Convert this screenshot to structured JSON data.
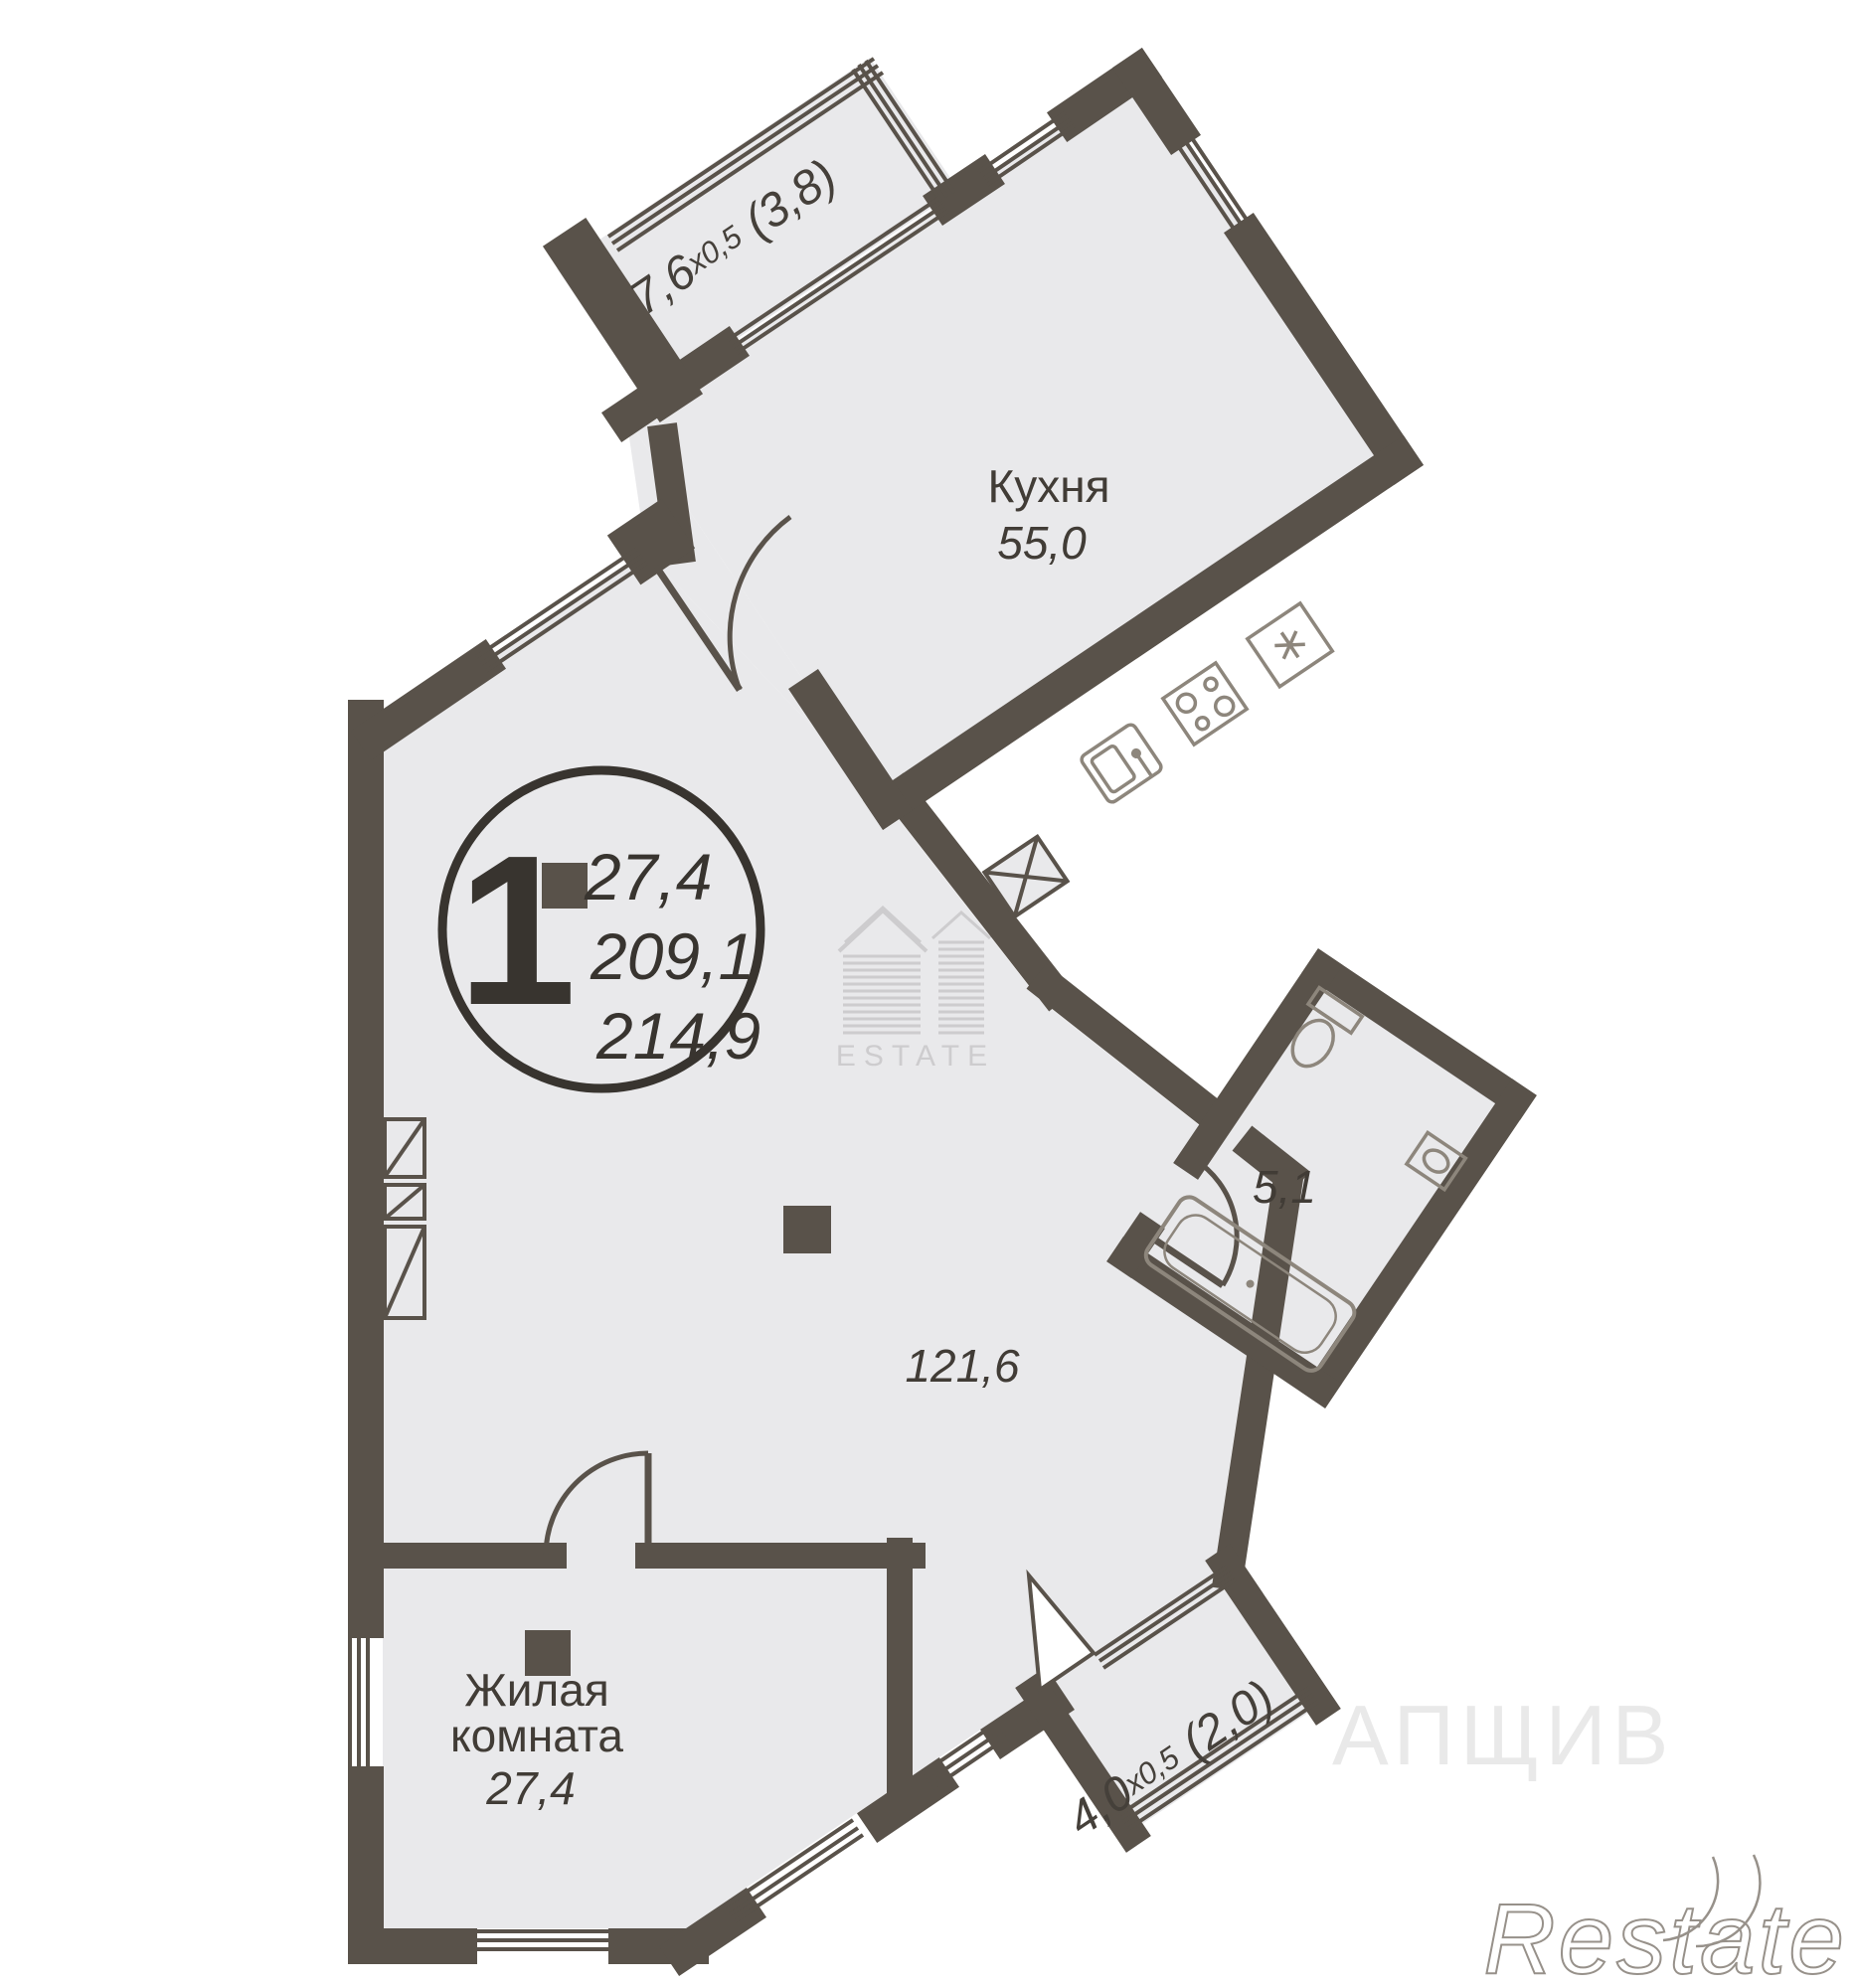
{
  "plan": {
    "unit_badge": {
      "rooms": "1",
      "room_area": "27,4",
      "living_area": "209,1",
      "total_area": "214,9"
    },
    "rooms": {
      "kitchen": {
        "name": "Кухня",
        "area": "55,0"
      },
      "main": {
        "area": "121,6"
      },
      "living": {
        "name_line1": "Жилая",
        "name_line2": "комната",
        "area": "27,4"
      },
      "bathroom": {
        "area": "5,1"
      }
    },
    "balconies": {
      "top": {
        "dim": "7,6",
        "factor": "х0,5",
        "reduced": " (3,8)"
      },
      "bottom": {
        "dim": "4,0",
        "factor": "х0,5",
        "reduced": " (2,0)"
      }
    },
    "watermarks": {
      "center_logo": "ESTATE",
      "corner": "Restate",
      "faint": "АПЩИВ"
    },
    "colors": {
      "wall": "#59524a",
      "floor": "#e9e9eb",
      "fixture": "#8d867c",
      "label": "#413c36"
    }
  }
}
